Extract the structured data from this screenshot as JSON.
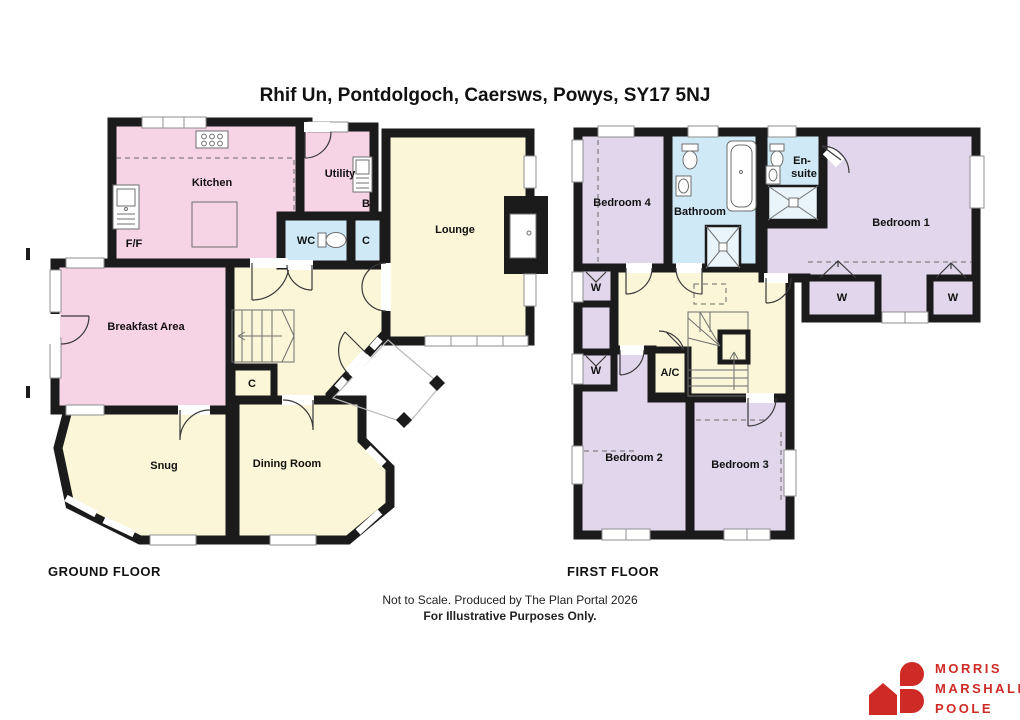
{
  "title": "Rhif Un, Pontdolgoch, Caersws, Powys, SY17 5NJ",
  "floors": {
    "ground": {
      "label": "GROUND FLOOR",
      "rooms": {
        "kitchen": "Kitchen",
        "utility": "Utility",
        "boiler": "B",
        "wc": "WC",
        "wc_cupboard": "C",
        "lounge": "Lounge",
        "fridge_freezer": "F/F",
        "breakfast": "Breakfast Area",
        "hall_cupboard": "C",
        "snug": "Snug",
        "dining": "Dining Room"
      }
    },
    "first": {
      "label": "FIRST FLOOR",
      "rooms": {
        "bedroom4": "Bedroom 4",
        "bathroom": "Bathroom",
        "ensuite_line1": "En-",
        "ensuite_line2": "suite",
        "bedroom1": "Bedroom 1",
        "bedroom2": "Bedroom 2",
        "bedroom3": "Bedroom 3",
        "airing_cupboard": "A/C",
        "wardrobe": "W"
      }
    }
  },
  "footer": {
    "line1": "Not to Scale. Produced by The Plan Portal 2026",
    "line2": "For Illustrative Purposes Only."
  },
  "logo": {
    "name_line1": "MORRIS",
    "name_line2": "MARSHALL",
    "name_line3": "POOLE"
  },
  "colors": {
    "wall": "#1b1b1b",
    "room_pink": "#f7d3e6",
    "room_yellow": "#faf6d7",
    "room_blue": "#cfe9f7",
    "room_lavender": "#e1d6ec",
    "logo_red": "#cf2b26"
  }
}
